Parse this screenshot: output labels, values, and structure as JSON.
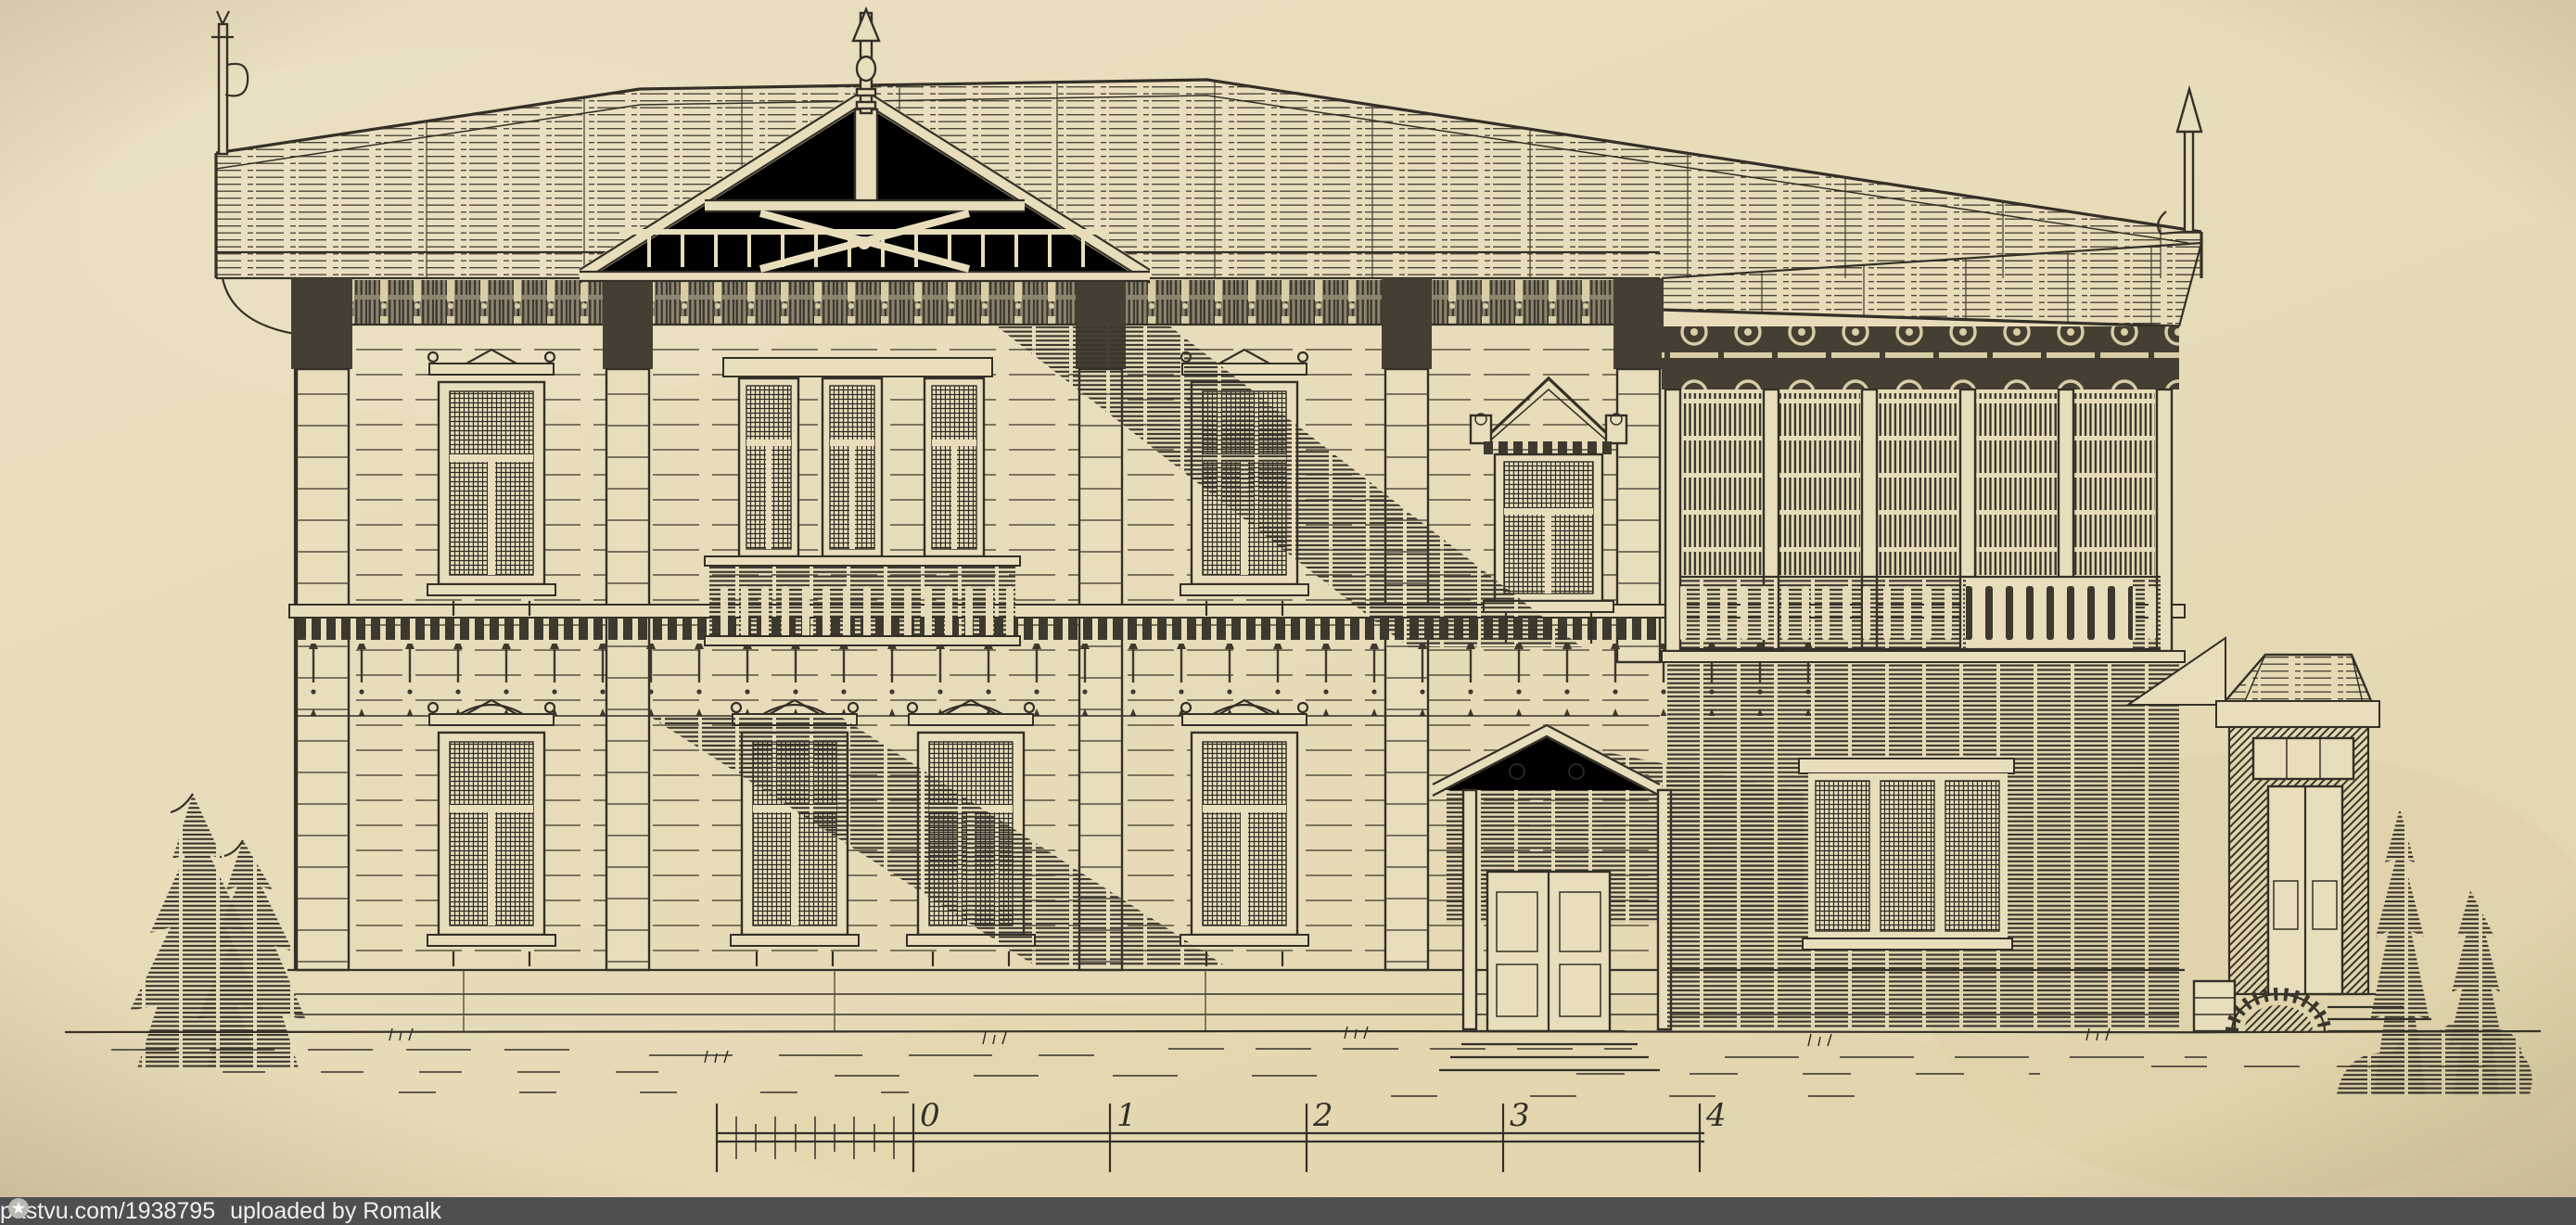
{
  "page": {
    "paper_color": "#e8ddba",
    "ink_color": "#333028",
    "vignette_color": "#5a4a28"
  },
  "artwork": {
    "type": "architectural-elevation-engraving",
    "subject": "Ornate two-storey wooden villa facade: carved central gable with finial, covered veranda wing with balustrade, pedimented main entrance, side entrance porch with brick arch, fir trees at left, cypress shrubs at right",
    "scale_bar": {
      "labels": [
        "0",
        "1",
        "2",
        "3",
        "4"
      ]
    }
  },
  "watermark": {
    "bar_color": "#4e4f51",
    "text_color": "#f1f0ed",
    "site_link": "pastvu.com/1938795",
    "uploaded_text": "uploaded by Romalk",
    "logo_icon": "star-in-circle-icon"
  }
}
